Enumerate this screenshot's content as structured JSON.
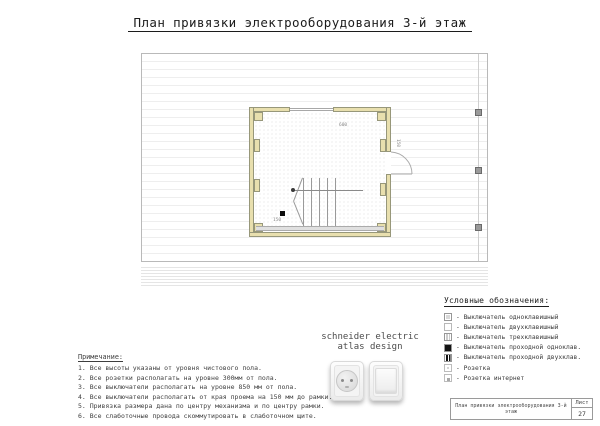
{
  "sheet": {
    "title": "План привязки электрооборудования 3-й этаж"
  },
  "plan": {
    "dim_top": "600",
    "dim_door": "150",
    "dim_switch": "150"
  },
  "brand": {
    "line1": "schneider electric",
    "line2": "atlas design"
  },
  "legend": {
    "title": "Условные обозначения:",
    "items": [
      {
        "icon": "switch-single-icon",
        "label": "- Выключатель одноклавишный"
      },
      {
        "icon": "switch-double-icon",
        "label": "- Выключатель двухклавишный"
      },
      {
        "icon": "switch-triple-icon",
        "label": "- Выключатель трехклавишный"
      },
      {
        "icon": "switch-pass-single-icon",
        "label": "- Выключатель проходной одноклав."
      },
      {
        "icon": "switch-pass-double-icon",
        "label": "- Выключатель проходной двухклав."
      },
      {
        "icon": "socket-icon",
        "label": "- Розетка"
      },
      {
        "icon": "socket-internet-icon",
        "label": "- Розетка интернет"
      }
    ]
  },
  "notes": {
    "title": "Примечание:",
    "lines": [
      "1. Все высоты указаны от уровня чистового пола.",
      "2. Все розетки располагать на уровне 300мм от пола.",
      "3. Все выключатели располагать на уровне 850 мм от пола.",
      "4. Все выключатели располагать от края проема на 150 мм до рамки.",
      "5. Привязка размера дана по центру механизма и по центру рамки.",
      "6. Все слаботочные провода скоммутировать в слаботочном щите."
    ]
  },
  "titleblock": {
    "doc_title": "План привязки электрооборудования 3-й этаж",
    "sheet_label": "Лист",
    "sheet_number": "27"
  },
  "colors": {
    "wall": "#e8dfae",
    "marker_gray": "#9a9a9a",
    "switch_black": "#0c0c0c"
  }
}
